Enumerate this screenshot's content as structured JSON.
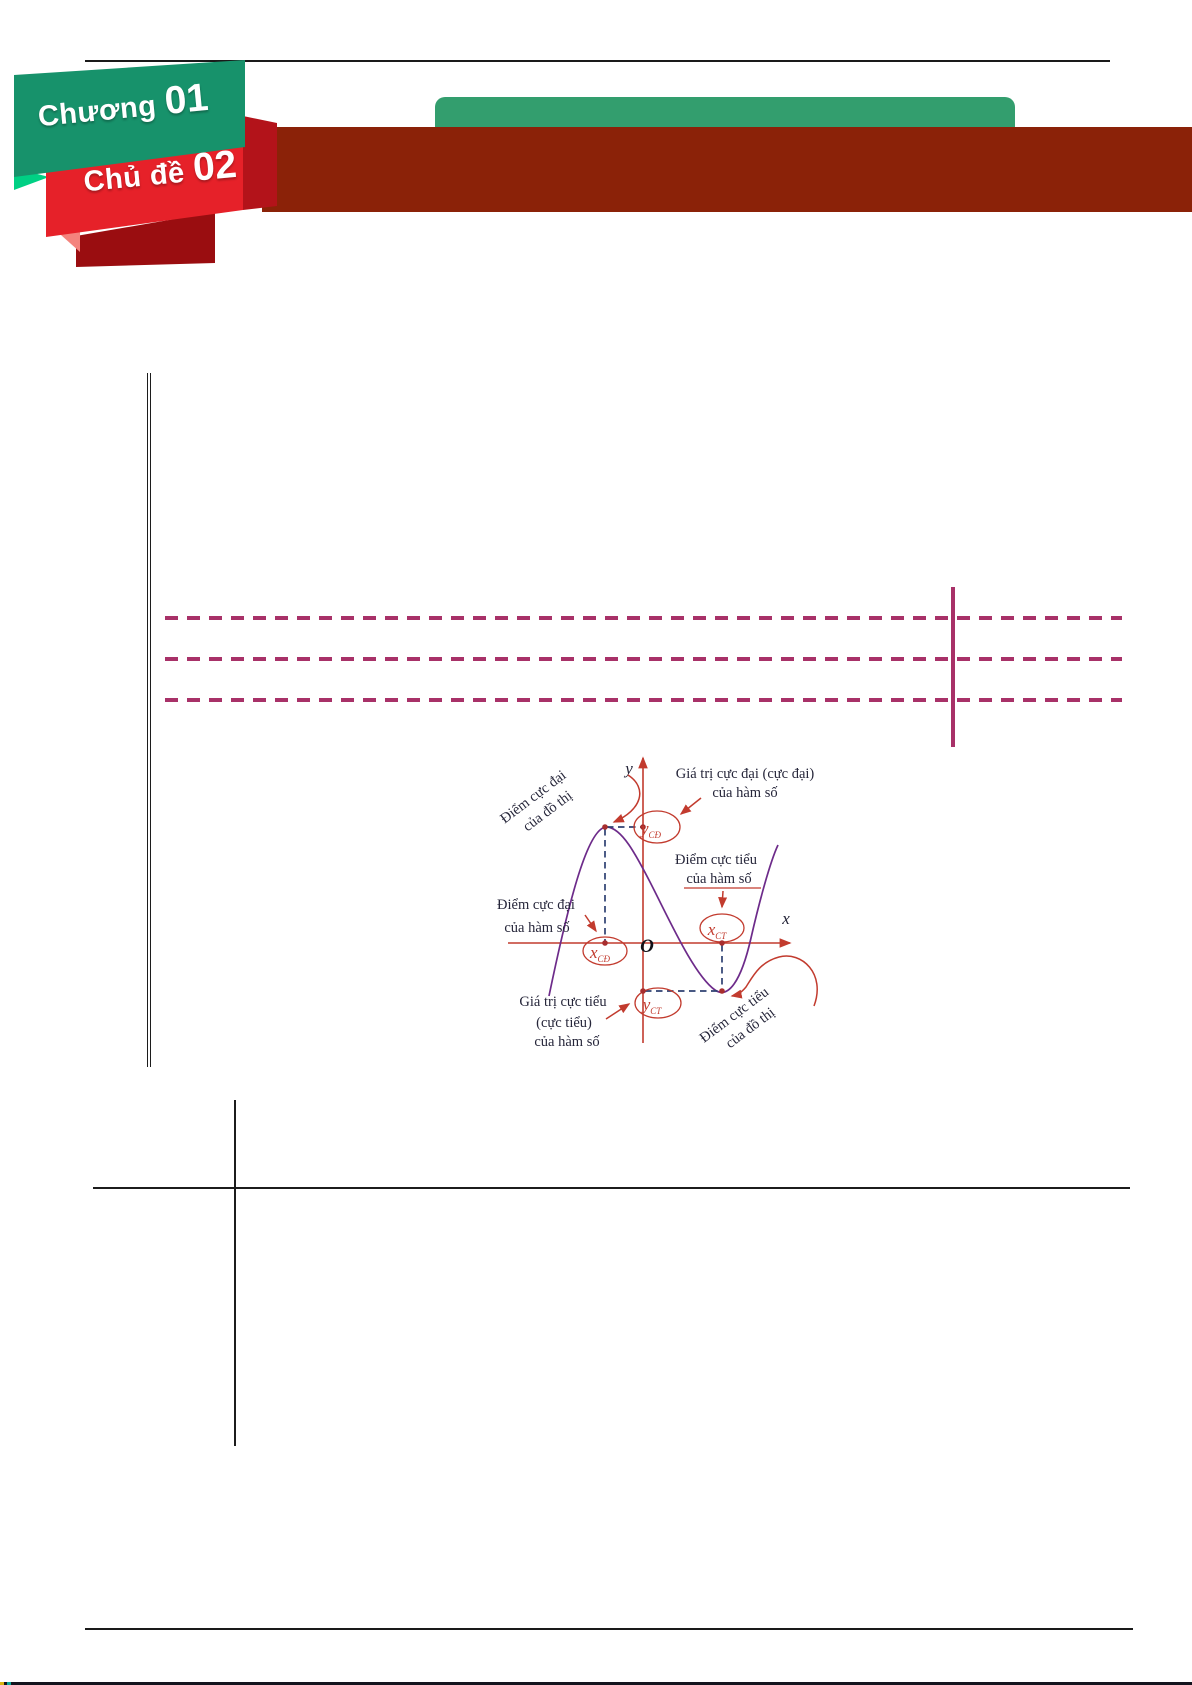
{
  "badge": {
    "chapter": {
      "label": "Chương",
      "number": "01"
    },
    "topic": {
      "label": "Chủ đề",
      "number": "02"
    }
  },
  "diagram": {
    "axis": {
      "y_label": "y",
      "x_label": "x",
      "origin": "O"
    },
    "points": {
      "x_cd": {
        "base": "x",
        "sub": "CĐ"
      },
      "y_cd": {
        "base": "y",
        "sub": "CĐ"
      },
      "x_ct": {
        "base": "x",
        "sub": "CT"
      },
      "y_ct": {
        "base": "y",
        "sub": "CT"
      }
    },
    "annotations": {
      "max_point_graph_line1": "Điểm cực đại",
      "max_point_graph_line2": "của đồ thị",
      "max_value_line1": "Giá trị cực đại (cực đại)",
      "max_value_line2": "của hàm số",
      "min_point_fn_line1": "Điểm cực tiểu",
      "min_point_fn_line2": "của hàm số",
      "max_point_fn_line1": "Điểm cực đại",
      "max_point_fn_line2": "của hàm số",
      "min_value_line1": "Giá trị cực tiểu",
      "min_value_line2": "(cực tiểu)",
      "min_value_line3": "của hàm số",
      "min_point_graph_line1": "Điểm cực tiểu",
      "min_point_graph_line2": "của đồ thị"
    }
  },
  "colors": {
    "ribbon_green": "#17926b",
    "ribbon_red": "#e62129",
    "ribbon_dark_red": "#9a0d10",
    "header_band_maroon": "#8b2208",
    "title_pill_green": "#339e6e",
    "dashed_line_magenta": "#a83168",
    "diagram_axis_red": "#c23b2e",
    "diagram_curve_purple": "#6d2b8a",
    "diagram_dash_navy": "#2e4172",
    "diagram_text_navy": "#26263a"
  }
}
